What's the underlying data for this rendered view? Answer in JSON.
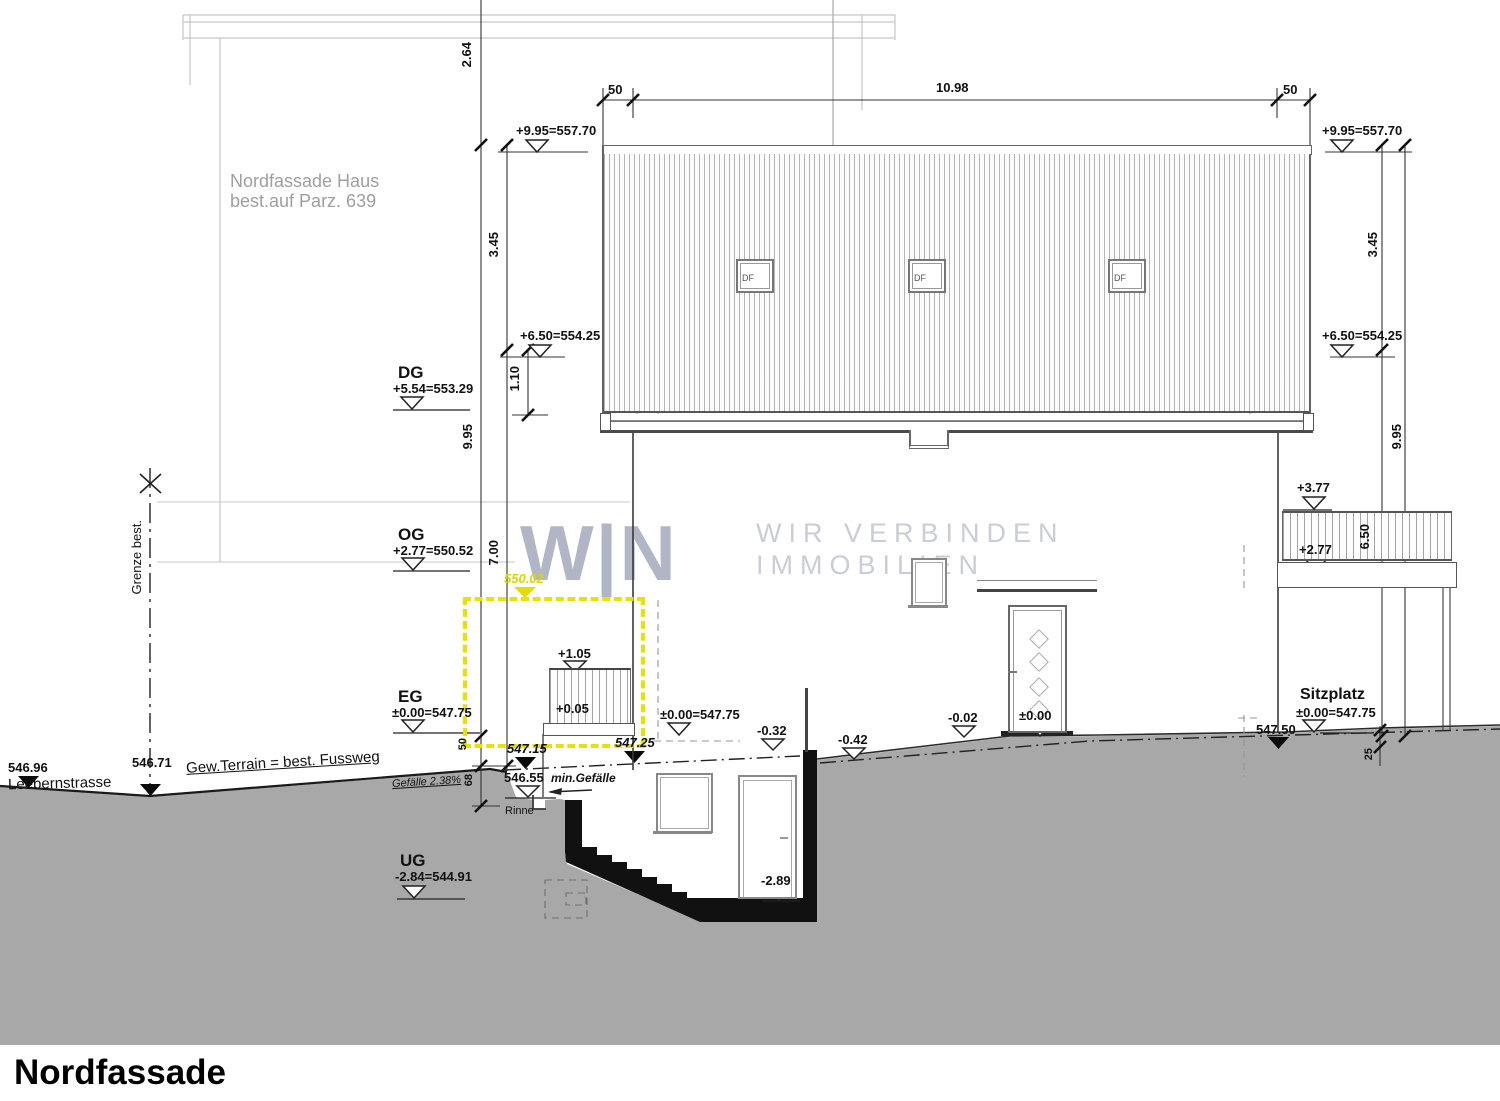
{
  "title": "Nordfassade",
  "colors": {
    "terrain_gray": "#a8a8a8",
    "highlight_yellow": "#ece800",
    "watermark_logo": "#b0b6c6",
    "watermark_text": "#c9cdd6",
    "section_black": "#111111"
  },
  "watermark": {
    "logo": "W|N",
    "line1": "WIR VERBINDEN",
    "line2": "IMMOBILIEN"
  },
  "neighbor": {
    "line1": "Nordfassade Haus",
    "line2": "best.auf Parz. 639"
  },
  "roof": {
    "df": "DF"
  },
  "levels": {
    "dg_label": "DG",
    "dg_value": "+5.54=553.29",
    "og_label": "OG",
    "og_value": "+2.77=550.52",
    "eg_label": "EG",
    "eg_value": "±0.00=547.75",
    "ug_label": "UG",
    "ug_value": "-2.84=544.91"
  },
  "markers": {
    "p995": "+9.95=557.70",
    "p650": "+6.50=554.25",
    "p377": "+3.77",
    "p277": "+2.77",
    "p105": "+1.05",
    "p005": "+0.05",
    "pm000_full": "±0.00=547.75",
    "pm000": "±0.00",
    "m032": "-0.32",
    "m042": "-0.42",
    "m002": "-0.02",
    "m289": "-2.89",
    "e54696": "546.96",
    "e54671": "546.71",
    "e54715": "547.15",
    "e54725": "547.25",
    "e54655": "546.55",
    "e54750": "547.50",
    "y55002": "550.02"
  },
  "dims": {
    "d264": "2.64",
    "d345": "3.45",
    "d110": "1.10",
    "d995": "9.95",
    "d700": "7.00",
    "d650": "6.50",
    "d50": "50",
    "d1098": "10.98",
    "d68": "68",
    "d25": "25"
  },
  "terrain": {
    "street": "Leebernstrasse",
    "grenze": "Grenze best.",
    "gew_terrain": "Gew.Terrain = best. Fussweg",
    "gefaelle": "Gefälle 2.38%",
    "min_gefaelle": "min.Gefälle",
    "rinne": "Rinne",
    "sitzplatz": "Sitzplatz"
  }
}
